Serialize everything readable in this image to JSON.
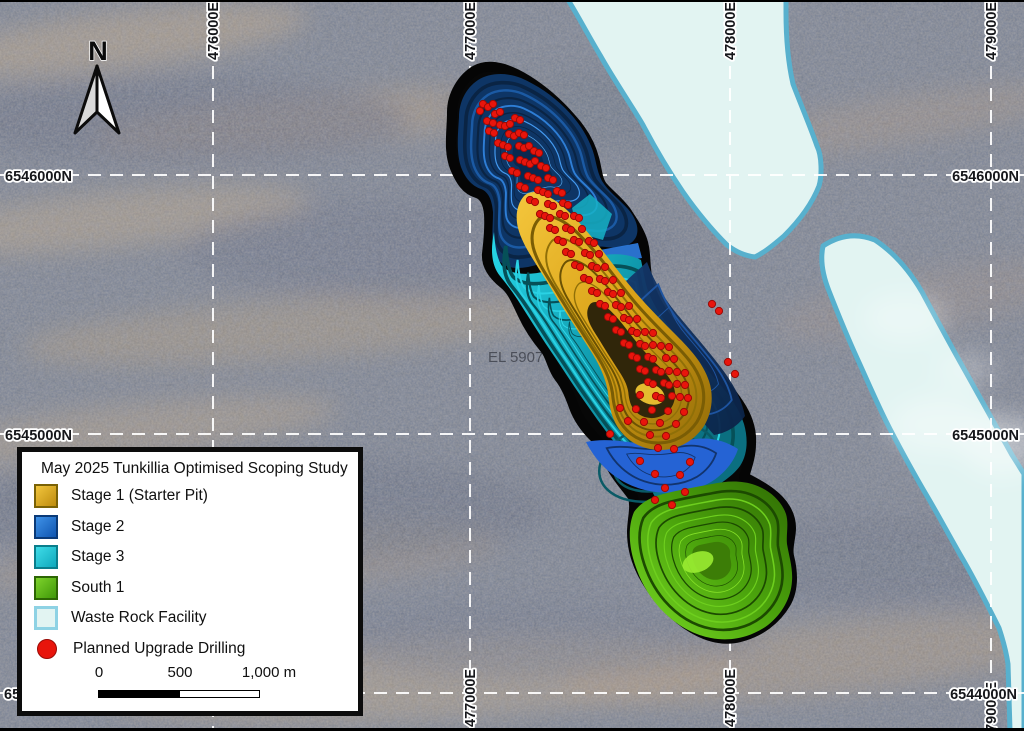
{
  "map": {
    "north_label": "N",
    "tenement_label": "EL 5907",
    "grid": {
      "eastings": [
        {
          "label": "476000E",
          "x": 213
        },
        {
          "label": "477000E",
          "x": 470
        },
        {
          "label": "478000E",
          "x": 730
        },
        {
          "label": "479000E",
          "x": 991
        }
      ],
      "northings": [
        {
          "label": "6546000N",
          "y": 175
        },
        {
          "label": "6545000N",
          "y": 434
        },
        {
          "label": "6544000N",
          "y": 693
        }
      ]
    }
  },
  "legend": {
    "title": "May 2025 Tunkillia Optimised Scoping Study",
    "items": [
      {
        "label": "Stage 1 (Starter Pit)",
        "key": "stage1"
      },
      {
        "label": "Stage 2",
        "key": "stage2"
      },
      {
        "label": "Stage 3",
        "key": "stage3"
      },
      {
        "label": "South 1",
        "key": "south1"
      },
      {
        "label": "Waste Rock Facility",
        "key": "wrf"
      },
      {
        "label": "Planned Upgrade Drilling",
        "key": "drill"
      }
    ],
    "scalebar": {
      "label_0": "0",
      "label_500": "500",
      "label_1000": "1,000 m"
    }
  },
  "colors": {
    "stage1_light": "#F2C63D",
    "stage1_dark": "#BD8B0E",
    "stage1_border": "#7A6206",
    "stage2_light": "#3F92E8",
    "stage2_dark": "#0F55B0",
    "stage2_border": "#0A3A78",
    "stage3_light": "#3FDCE8",
    "stage3_dark": "#0FA8BC",
    "stage3_border": "#0A7E8C",
    "south1_light": "#7ED32C",
    "south1_dark": "#3F9708",
    "south1_border": "#2D6604",
    "wrf_fill": "#E2F4F2",
    "wrf_border": "#58B0CD",
    "drill": "#E8150C",
    "drill_border": "#9A0B06"
  },
  "drill_points": [
    [
      483,
      104
    ],
    [
      488,
      107
    ],
    [
      493,
      104
    ],
    [
      480,
      111
    ],
    [
      495,
      114
    ],
    [
      500,
      112
    ],
    [
      487,
      121
    ],
    [
      493,
      123
    ],
    [
      500,
      125
    ],
    [
      505,
      126
    ],
    [
      510,
      124
    ],
    [
      515,
      118
    ],
    [
      520,
      120
    ],
    [
      489,
      131
    ],
    [
      494,
      133
    ],
    [
      509,
      134
    ],
    [
      514,
      136
    ],
    [
      519,
      133
    ],
    [
      524,
      135
    ],
    [
      498,
      143
    ],
    [
      503,
      145
    ],
    [
      508,
      147
    ],
    [
      519,
      146
    ],
    [
      524,
      148
    ],
    [
      529,
      146
    ],
    [
      534,
      151
    ],
    [
      539,
      153
    ],
    [
      505,
      156
    ],
    [
      510,
      158
    ],
    [
      520,
      160
    ],
    [
      525,
      162
    ],
    [
      530,
      164
    ],
    [
      535,
      161
    ],
    [
      541,
      166
    ],
    [
      546,
      168
    ],
    [
      512,
      171
    ],
    [
      517,
      173
    ],
    [
      528,
      176
    ],
    [
      533,
      178
    ],
    [
      538,
      180
    ],
    [
      548,
      178
    ],
    [
      553,
      180
    ],
    [
      520,
      186
    ],
    [
      525,
      188
    ],
    [
      538,
      190
    ],
    [
      543,
      192
    ],
    [
      548,
      194
    ],
    [
      557,
      191
    ],
    [
      562,
      193
    ],
    [
      530,
      200
    ],
    [
      535,
      202
    ],
    [
      548,
      204
    ],
    [
      553,
      206
    ],
    [
      563,
      203
    ],
    [
      568,
      205
    ],
    [
      540,
      214
    ],
    [
      545,
      216
    ],
    [
      550,
      218
    ],
    [
      560,
      214
    ],
    [
      565,
      216
    ],
    [
      574,
      216
    ],
    [
      579,
      218
    ],
    [
      550,
      228
    ],
    [
      555,
      230
    ],
    [
      566,
      228
    ],
    [
      571,
      230
    ],
    [
      582,
      229
    ],
    [
      558,
      240
    ],
    [
      563,
      242
    ],
    [
      574,
      240
    ],
    [
      579,
      242
    ],
    [
      589,
      241
    ],
    [
      594,
      243
    ],
    [
      566,
      252
    ],
    [
      571,
      254
    ],
    [
      585,
      253
    ],
    [
      590,
      255
    ],
    [
      599,
      254
    ],
    [
      575,
      265
    ],
    [
      580,
      267
    ],
    [
      592,
      266
    ],
    [
      597,
      268
    ],
    [
      605,
      267
    ],
    [
      584,
      278
    ],
    [
      589,
      280
    ],
    [
      600,
      279
    ],
    [
      605,
      281
    ],
    [
      613,
      280
    ],
    [
      592,
      291
    ],
    [
      597,
      293
    ],
    [
      608,
      292
    ],
    [
      613,
      294
    ],
    [
      621,
      293
    ],
    [
      600,
      304
    ],
    [
      605,
      306
    ],
    [
      616,
      305
    ],
    [
      621,
      307
    ],
    [
      629,
      306
    ],
    [
      712,
      304
    ],
    [
      719,
      311
    ],
    [
      608,
      317
    ],
    [
      613,
      319
    ],
    [
      624,
      318
    ],
    [
      629,
      320
    ],
    [
      637,
      319
    ],
    [
      616,
      330
    ],
    [
      621,
      332
    ],
    [
      632,
      331
    ],
    [
      637,
      333
    ],
    [
      645,
      332
    ],
    [
      653,
      333
    ],
    [
      624,
      343
    ],
    [
      629,
      345
    ],
    [
      640,
      344
    ],
    [
      645,
      346
    ],
    [
      653,
      345
    ],
    [
      661,
      346
    ],
    [
      669,
      347
    ],
    [
      632,
      356
    ],
    [
      637,
      358
    ],
    [
      648,
      357
    ],
    [
      653,
      359
    ],
    [
      666,
      358
    ],
    [
      674,
      359
    ],
    [
      728,
      362
    ],
    [
      640,
      369
    ],
    [
      645,
      371
    ],
    [
      656,
      370
    ],
    [
      661,
      372
    ],
    [
      669,
      371
    ],
    [
      677,
      372
    ],
    [
      685,
      373
    ],
    [
      735,
      374
    ],
    [
      648,
      382
    ],
    [
      653,
      384
    ],
    [
      664,
      383
    ],
    [
      669,
      385
    ],
    [
      677,
      384
    ],
    [
      685,
      385
    ],
    [
      640,
      395
    ],
    [
      656,
      396
    ],
    [
      661,
      398
    ],
    [
      672,
      396
    ],
    [
      680,
      397
    ],
    [
      688,
      398
    ],
    [
      620,
      408
    ],
    [
      636,
      409
    ],
    [
      652,
      410
    ],
    [
      668,
      411
    ],
    [
      684,
      412
    ],
    [
      628,
      421
    ],
    [
      644,
      422
    ],
    [
      660,
      423
    ],
    [
      676,
      424
    ],
    [
      610,
      434
    ],
    [
      650,
      435
    ],
    [
      666,
      436
    ],
    [
      658,
      448
    ],
    [
      674,
      449
    ],
    [
      640,
      461
    ],
    [
      690,
      462
    ],
    [
      655,
      474
    ],
    [
      680,
      475
    ],
    [
      665,
      488
    ],
    [
      685,
      492
    ],
    [
      655,
      500
    ],
    [
      672,
      505
    ]
  ]
}
